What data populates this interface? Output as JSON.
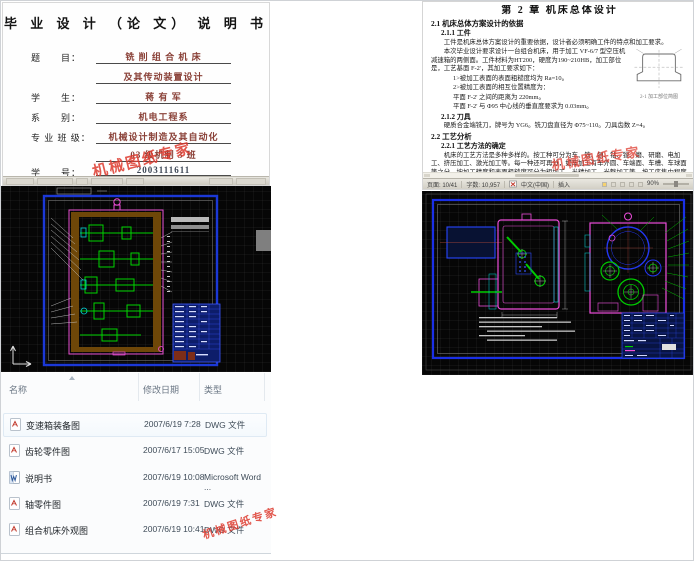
{
  "watermark": {
    "text": "机械图纸专家",
    "color": "#dd3a2e"
  },
  "cover": {
    "title": "毕 业 设 计 （论 文） 说 明 书",
    "fields": [
      {
        "label": "题　　目：",
        "value": "铣 削 组 合 机 床"
      },
      {
        "label": "",
        "value": "及其传动装置设计"
      },
      {
        "label": "学　　生：",
        "value": "蒋  有  军"
      },
      {
        "label": "系　　别：",
        "value": "机电工程系"
      },
      {
        "label": "专 业 班 级：",
        "value": "机械设计制造及其自动化"
      },
      {
        "label": "",
        "value": "03 级机制 3 班"
      },
      {
        "label": "学　　号：",
        "value": "2003111611"
      }
    ]
  },
  "chapter": {
    "title": "第 2 章  机床总体设计",
    "s21": "2.1 机床总体方案设计的依据",
    "s211": "2.1.1 工件",
    "p1": "工件是机床总体方案设计的重要依据，设计者必须明确工件的特点和加工要求。",
    "p2": "本次毕业设计要求设计一台组合机床，用于加工 VF-6/7 型空压机减速箱的两侧面。工件材料为HT200，硬度为190~210HB，加工部位是，工艺基面 F-2'，其加工要求如下：",
    "li1": "1>被加工表面的表面粗糙度均为 Ra=10。",
    "li2": "2>被加工表面的相互位置精度为：",
    "li3": "平面 F-2' 之间的距离为 220mm。",
    "li4": "平面 F-2' 与 Φ95 中心线的垂直度要求为 0.03mm。",
    "s212": "2.1.2 刀具",
    "p3": "硬质合金端铣刀，牌号为 YG6。铣刀盘直径为 Φ75~110。刀具齿数 Z=4。",
    "s22": "2.2 工艺分析",
    "s221": "2.2.1 工艺方法的确定",
    "p4": "机床的工艺方法是多种多样的。按工种可分为车、铣、刨、钻、镗、磨、研磨、电加工、挤压加工、激光加工等。每一种还可再分，如车加工有车外圆、车端面、车槽、车球面等之分。按加工精度和表面粗糙度可分为粗加工、半精加工、光整加工等。按工序集中程度可分为单刀、多刀加工、单工位、多工位、多",
    "fig_caption": "2-1 加工部位简图"
  },
  "statusbar": {
    "page": "页面: 10/41",
    "words": "字数: 10,957",
    "lang": "中文(中国)",
    "mode": "插入",
    "zoom": "90%"
  },
  "files": {
    "columns": [
      "名称",
      "修改日期",
      "类型"
    ],
    "rows": [
      {
        "name": "变速箱装备图",
        "date": "2007/6/19 7:28",
        "type": "DWG 文件"
      },
      {
        "name": "齿轮零件图",
        "date": "2007/6/17 15:05",
        "type": "DWG 文件"
      },
      {
        "name": "说明书",
        "date": "2007/6/19 10:08",
        "type": "Microsoft Word ..."
      },
      {
        "name": "轴零件图",
        "date": "2007/6/19 7:31",
        "type": "DWG 文件"
      },
      {
        "name": "组合机床外观图",
        "date": "2007/6/19 10:41",
        "type": "DWG 文件"
      }
    ]
  },
  "colors": {
    "cad_frame_blue": "#1a2fe6",
    "cad_green": "#00cc00",
    "cad_magenta": "#ec4cda",
    "cad_cyan": "#00d6d6",
    "watermark_red": "#dd3a2e"
  }
}
